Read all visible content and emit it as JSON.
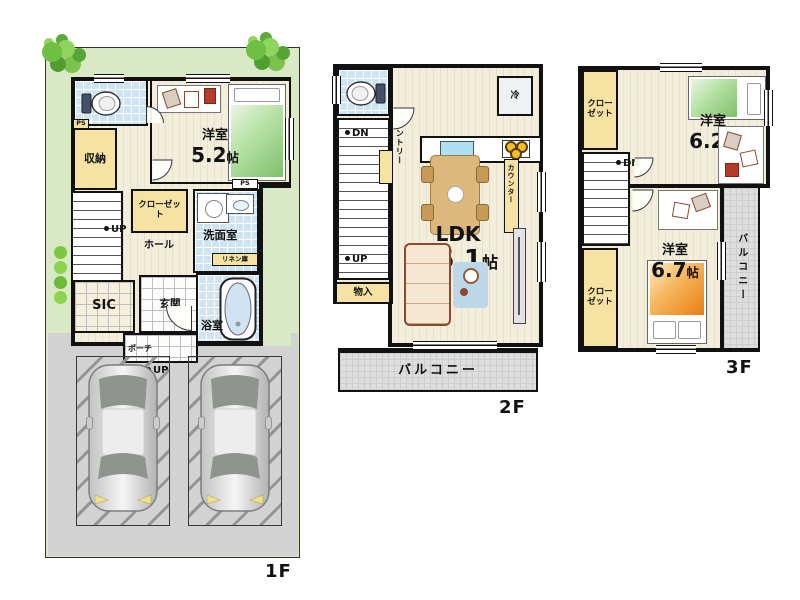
{
  "floor1": {
    "label": "1F",
    "bedroom": {
      "name": "洋室",
      "size": "5.2",
      "unit": "帖"
    },
    "storage": "収納",
    "ps_top": "PS",
    "closet": "クローゼット",
    "hall": "ホール",
    "stairs_up": "UP",
    "washroom": "洗面室",
    "ps_washroom": "PS",
    "linen": "リネン庫",
    "sic": "SIC",
    "entrance": "玄関",
    "bathroom": "浴室",
    "porch": "ポーチ",
    "porch_up": "UP"
  },
  "floor2": {
    "label": "2F",
    "stairs_dn": "DN",
    "stairs_up": "UP",
    "pantry": "パントリー",
    "storage": "物入",
    "fridge": "冷",
    "counter": "カウンター",
    "ldk": {
      "name": "LDK",
      "size": "16.1",
      "unit": "帖"
    },
    "balcony": "バルコニー"
  },
  "floor3": {
    "label": "3F",
    "closet_upper": "クローゼット",
    "bedroom_upper": {
      "name": "洋室",
      "size": "6.2",
      "unit": "帖"
    },
    "stairs_dn": "DN",
    "closet_lower": "クローゼット",
    "bedroom_lower": {
      "name": "洋室",
      "size": "6.7",
      "unit": "帖"
    },
    "balcony": "バルコニー"
  },
  "colors": {
    "wall": "#111111",
    "lawn": "#d9e9c6",
    "driveway": "#d2d2d2",
    "wood_floor": "#f3eedb",
    "tile_blue": "#cfe4f0",
    "closet_tan": "#f6e2a2",
    "balcony_gray": "#dedede",
    "bed_green": "#7ec06a",
    "bed_orange": "#e87d12"
  }
}
